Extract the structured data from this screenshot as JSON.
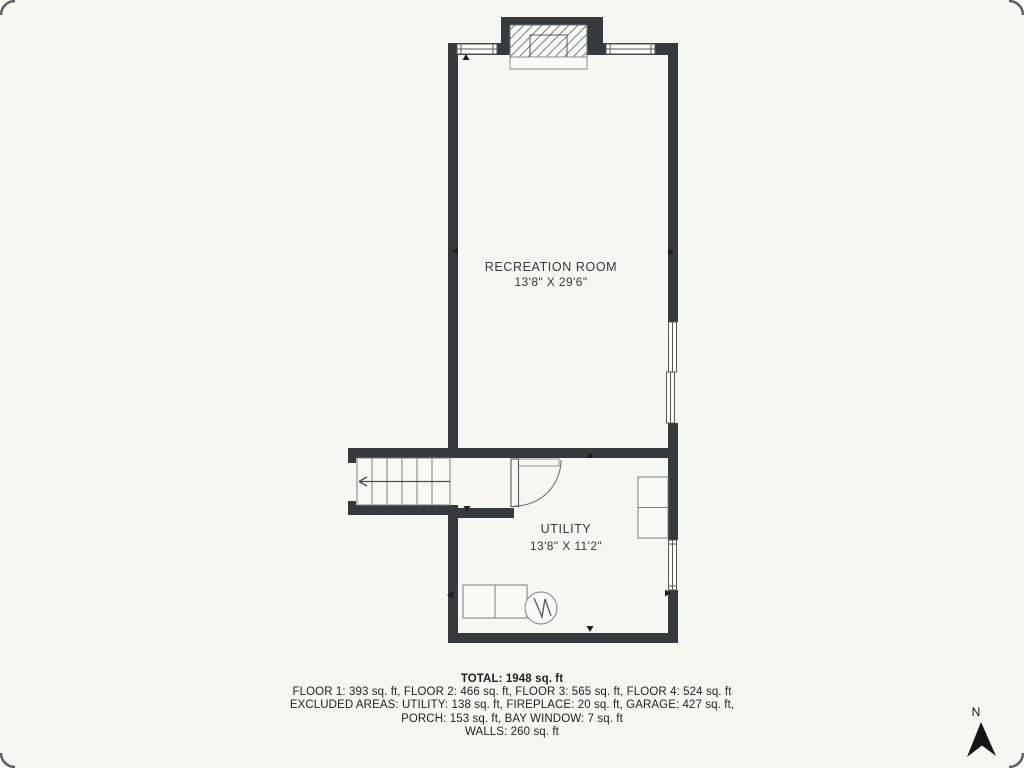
{
  "colors": {
    "background": "#f7f7f1",
    "wall": "#343a3d",
    "thin_line": "#6d7275",
    "text": "#2e2e2e"
  },
  "plan": {
    "compass": "N",
    "rooms": [
      {
        "label": "RECREATION ROOM",
        "dims": "13'8\" X 29'6\""
      },
      {
        "label": "UTILITY",
        "dims": "13'8\" X 11'2\""
      }
    ],
    "symbols": [
      "fireplace",
      "stairs",
      "door",
      "windows",
      "washer-dryer",
      "water-heater",
      "cabinet"
    ]
  },
  "summary": {
    "total": "TOTAL: 1948 sq. ft",
    "line1": "FLOOR 1: 393 sq. ft, FLOOR 2: 466 sq. ft, FLOOR 3: 565 sq. ft, FLOOR 4: 524 sq. ft",
    "line2": "EXCLUDED AREAS: UTILITY: 138 sq. ft, FIREPLACE: 20 sq. ft, GARAGE: 427 sq. ft,",
    "line3": "PORCH: 153 sq. ft, BAY WINDOW: 7 sq. ft",
    "line4": "WALLS: 260 sq. ft"
  }
}
